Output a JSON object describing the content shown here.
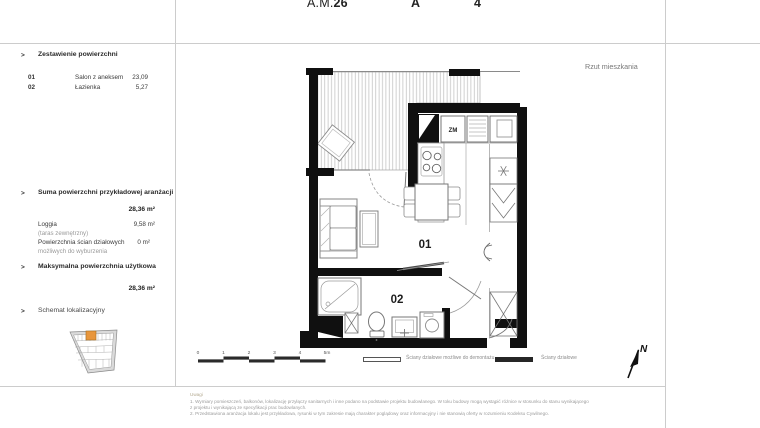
{
  "header": {
    "unit_prefix": "A.M.",
    "unit_number": "26",
    "building": "A",
    "floor": "4"
  },
  "plan_title": "Rzut mieszkania",
  "areas": {
    "title": "Zestawienie powierzchni",
    "rows": [
      {
        "no": "01",
        "name": "Salon z aneksem",
        "value": "23,09"
      },
      {
        "no": "02",
        "name": "Łazienka",
        "value": "5,27"
      }
    ]
  },
  "summary": {
    "title": "Suma powierzchni przykładowej aranżacji",
    "total": "28,36 m²",
    "rows": [
      {
        "name": "Loggia",
        "sub": "(taras zewnętrzny)",
        "value": "9,58 m²"
      },
      {
        "name": "Powierzchnia ścian działowych",
        "sub": "możliwych do wyburzenia",
        "value": "0 m²"
      }
    ]
  },
  "max_area": {
    "title": "Maksymalna powierzchnia użytkowa",
    "total": "28,36 m²"
  },
  "location": {
    "title": "Schemat lokalizacyjny"
  },
  "plan": {
    "room_01": "01",
    "room_02": "02",
    "shaft_label": "ZM",
    "north": "N"
  },
  "scalebar": {
    "ticks": [
      "0",
      "1",
      "2",
      "3",
      "4",
      "5m"
    ]
  },
  "legend": [
    {
      "label": "Ściany działowe możliwe do demontażu",
      "style": "outline"
    },
    {
      "label": "Ściany działowe",
      "style": "solid"
    }
  ],
  "notes": {
    "title": "Uwagi",
    "lines": [
      "1. Wymiary pomieszczeń, balkonów, lokalizację przyłączy sanitarnych i inne podano na podstawie projektu budowlanego. W toku budowy mogą wystąpić różnice w stosunku do stanu wynikającego",
      "z projektu i wynikającą ze specyfikacji prac budowlanych.",
      "2. Przedstawiona aranżacja lokalu jest przykładowa, rysunki w tym zakresie mają charakter poglądowy oraz informacyjny i nie stanowią oferty w rozumieniu Kodeksu Cywilnego."
    ]
  },
  "colors": {
    "accent": "#e8963c",
    "wall": "#111111",
    "grid_line": "#cccccc",
    "muted_text": "#8a8a8a"
  }
}
